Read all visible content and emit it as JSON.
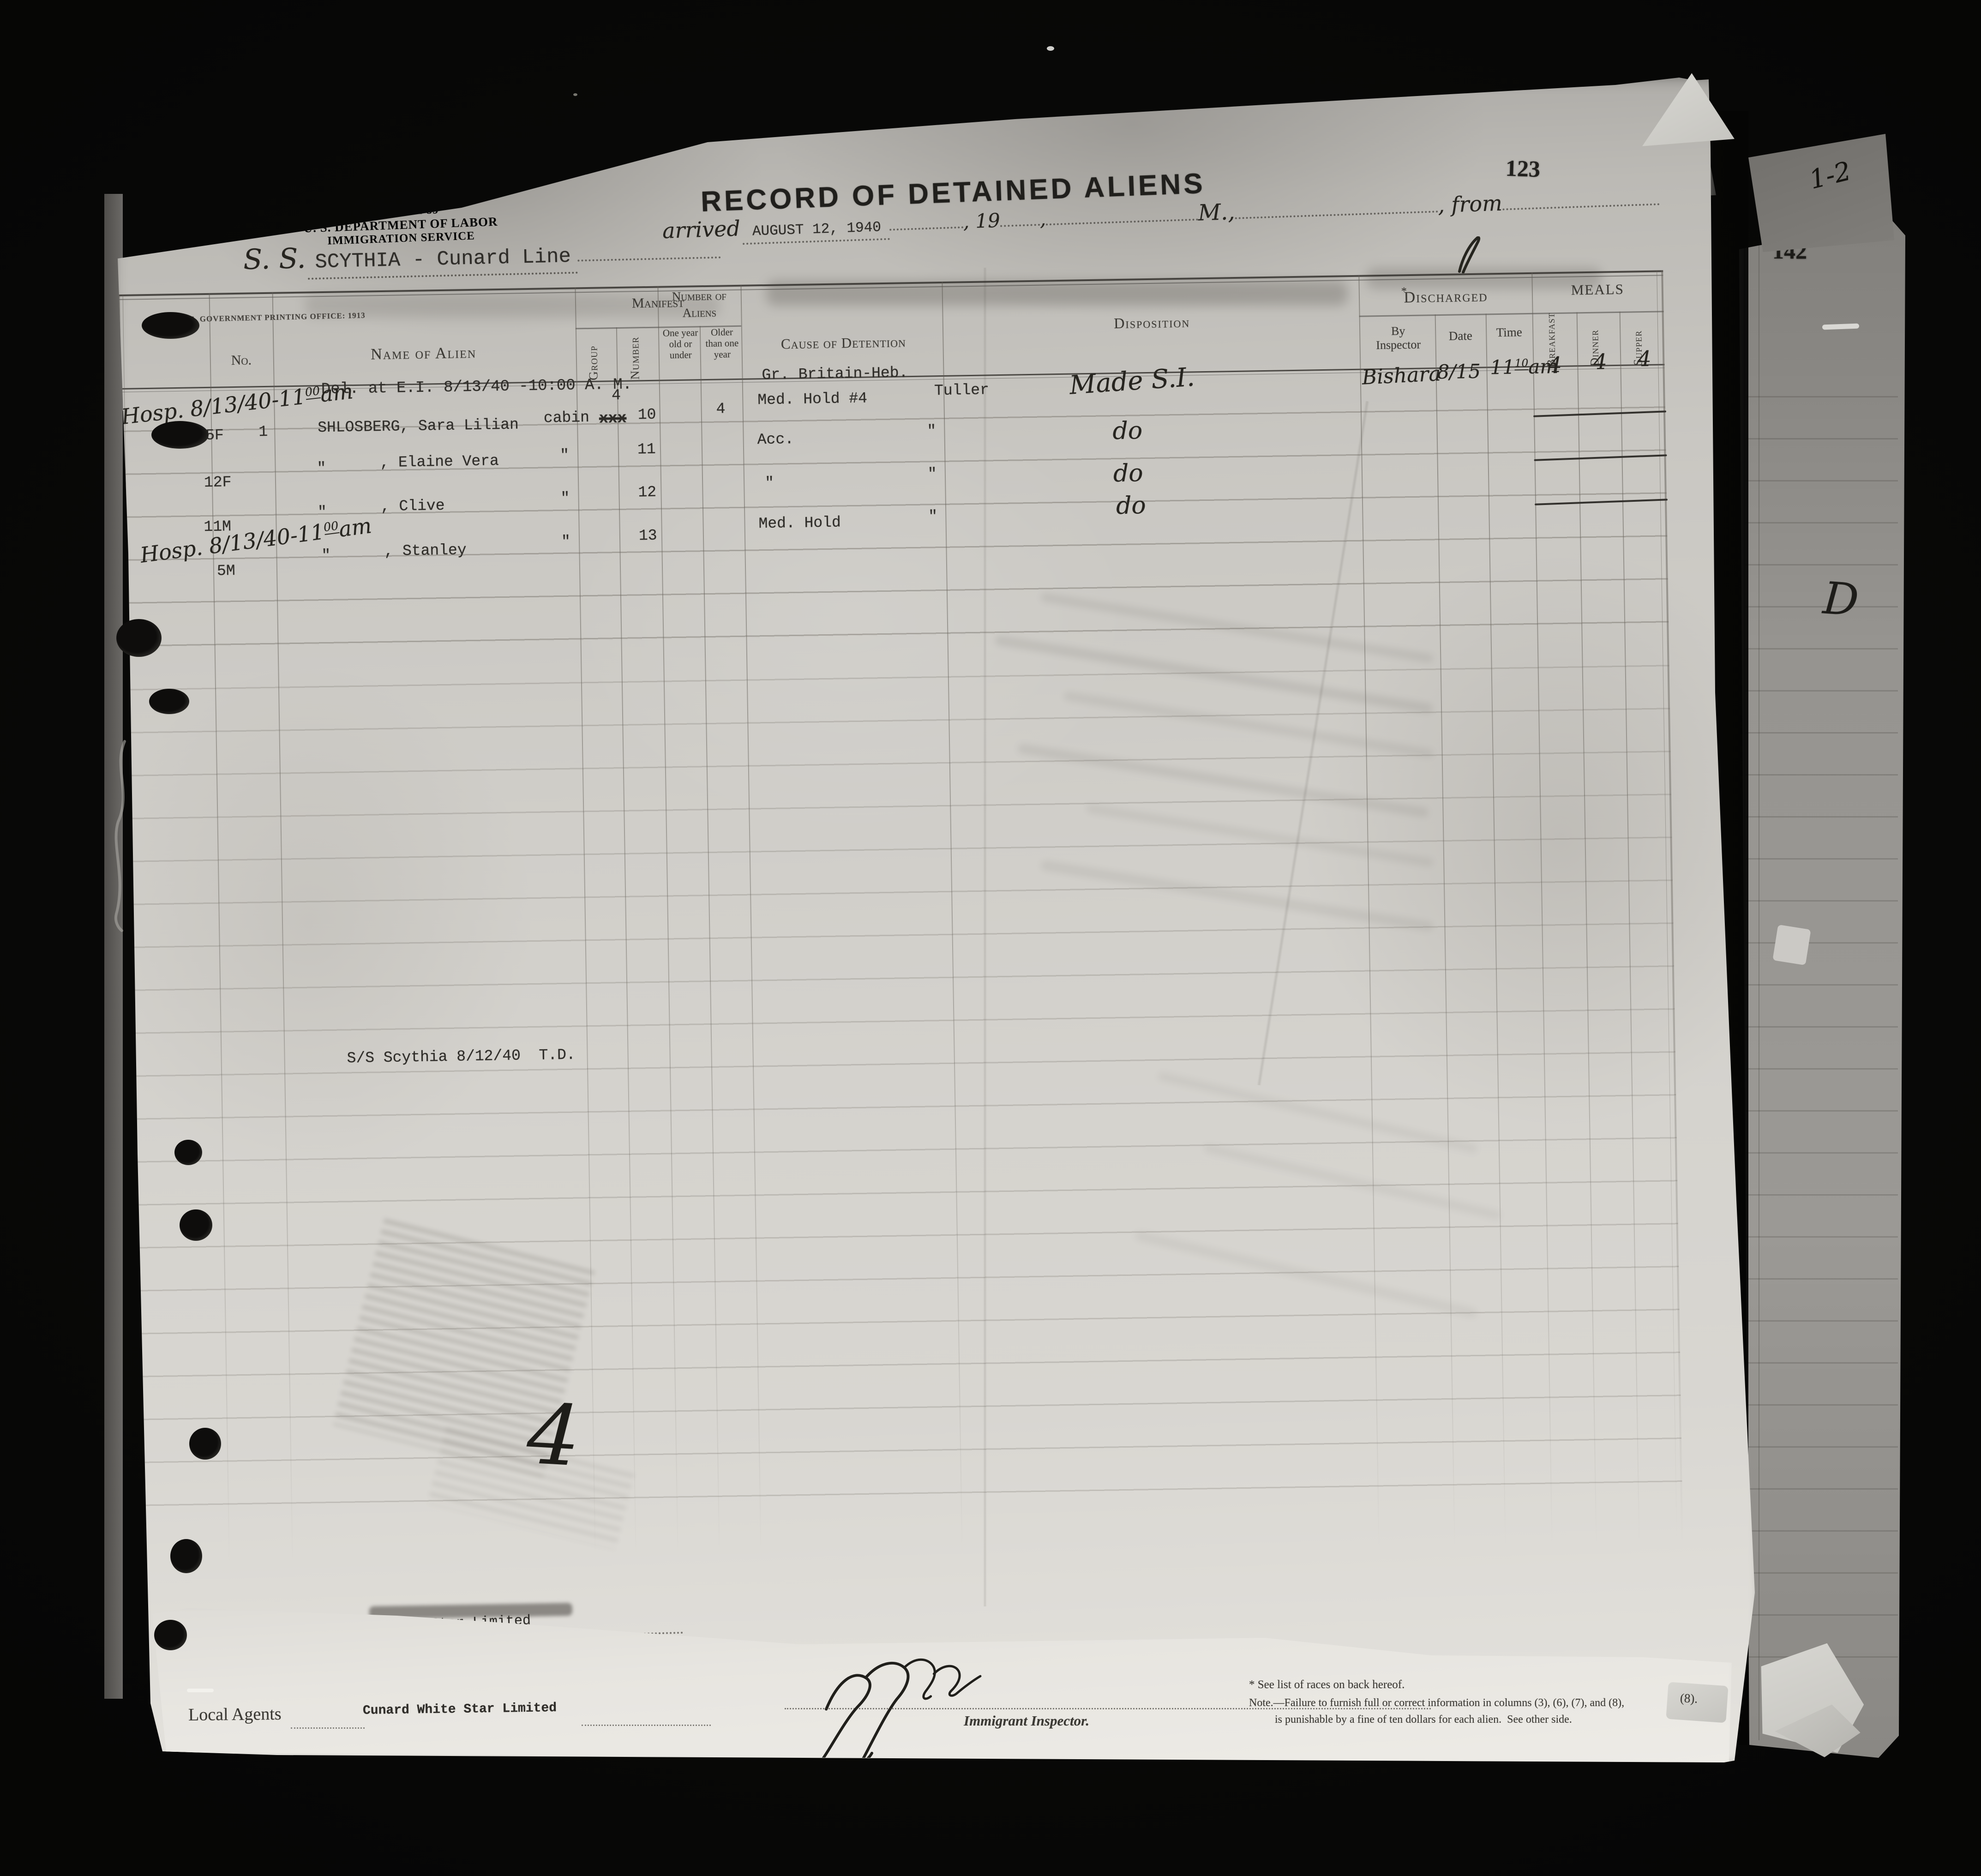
{
  "colors": {
    "paper": "#d3d1cc",
    "paper_bright": "#eae8e3",
    "background": "#070706",
    "ink_typed": "#2f2d29",
    "ink_hand": "#26241f",
    "ink_print": "#3b3934"
  },
  "annotations": {
    "page_stamp": "123",
    "side_page_stamp": "142",
    "side_note": "1-2",
    "side_letter": "D",
    "corner_fragment": "(8)."
  },
  "header": {
    "form_id_line1": "N. Y. Form 89",
    "form_id_line2": "U. S. DEPARTMENT OF LABOR",
    "form_id_line3": "IMMIGRATION SERVICE",
    "title": "RECORD OF DETAINED ALIENS",
    "printing_office": "U. S. GOVERNMENT PRINTING OFFICE: 1913",
    "arrived_label": "arrived",
    "arrived_date": "AUGUST 12, 1940",
    "year_label": ", 19",
    "comma": ",",
    "meridiem_label": "M.,",
    "from_label": ", from",
    "ship_prefix": "S. S.",
    "ship_name": "SCYTHIA - Cunard Line"
  },
  "table": {
    "headers": {
      "no": "No.",
      "name": "Name of Alien",
      "manifest": "Manifest",
      "group": "Group",
      "number": "Number",
      "aliens_line1": "Number of",
      "aliens_line2": "Aliens",
      "one_year": "One year old or under",
      "older": "Older than one year",
      "cause": "Cause of Detention",
      "disposition": "Disposition",
      "discharged_star": "*",
      "discharged": "Discharged",
      "by_inspector": "By Inspector",
      "date": "Date",
      "time": "Time",
      "meals": "MEALS",
      "breakfast": "Breakfast",
      "dinner": "Dinner",
      "supper": "Supper"
    },
    "delivery_note": "Del. at E.I. 8/13/40 -10:00 A. M.",
    "race_note": "Gr. Britain-Heb.",
    "margin_note_1": {
      "base": "Hosp. 8/13/40-11",
      "sup": "00",
      "suffix": "am"
    },
    "margin_note_2": {
      "base": "Hosp. 8/13/40-11",
      "sup": "00",
      "suffix": "am"
    },
    "rows": [
      {
        "age_sex": "45F",
        "no": "1",
        "name": "SHLOSBERG, Sara Lilian",
        "class": "cabin",
        "group_corrected": "4",
        "group_struck": "xxx",
        "number": "10",
        "older": "4",
        "cause": "Med. Hold #4",
        "inspector": "Tuller",
        "disposition": "Made S.I.",
        "discharged_by": "Bishara",
        "discharged_date": "8/15",
        "time_base": "11",
        "time_sup": "10",
        "time_suffix": "am",
        "breakfast": "4",
        "dinner": "4",
        "supper": "4"
      },
      {
        "age_sex": "12F",
        "name_ditto": "\"",
        "name": ", Elaine Vera",
        "class_ditto": "\"",
        "number": "11",
        "cause": "Acc.",
        "inspector_ditto": "\"",
        "disposition": "do"
      },
      {
        "age_sex": "11M",
        "name_ditto": "\"",
        "name": ", Clive",
        "class_ditto": "\"",
        "number": "12",
        "cause_ditto": "\"",
        "inspector_ditto": "\"",
        "disposition": "do"
      },
      {
        "age_sex": "5M",
        "name_ditto": "\"",
        "name": ", Stanley",
        "class_ditto": "\"",
        "number": "13",
        "cause": "Med. Hold",
        "inspector_ditto": "\"",
        "disposition": "do"
      }
    ],
    "mid_note": "S/S Scythia 8/12/40  T.D.",
    "hand_number": "4"
  },
  "footer": {
    "agents_label": "Local Agents",
    "agents_value": "Cunard White Star Limited",
    "agents_fragment": "Star Limited",
    "inspector_label": "Immigrant Inspector.",
    "note1": "* See list of races on back hereof.",
    "note2": "Note.—Failure to furnish full or correct information in columns (3), (6), (7), and (8),",
    "note3": "is punishable by a fine of ten dollars for each alien.  See other side."
  }
}
